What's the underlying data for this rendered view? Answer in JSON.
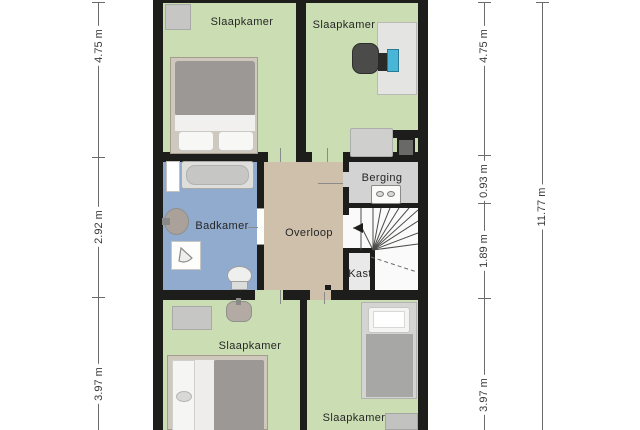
{
  "rooms": [
    {
      "id": "bedroom-top-left",
      "label": "Slaapkamer"
    },
    {
      "id": "bedroom-top-right",
      "label": "Slaapkamer"
    },
    {
      "id": "bathroom",
      "label": "Badkamer"
    },
    {
      "id": "landing",
      "label": "Overloop"
    },
    {
      "id": "storage",
      "label": "Berging"
    },
    {
      "id": "closet",
      "label": "Kast"
    },
    {
      "id": "bedroom-bottom-left",
      "label": "Slaapkamer"
    },
    {
      "id": "bedroom-bottom-right",
      "label": "Slaapkamer"
    }
  ],
  "dimensions": {
    "left": [
      "4.75 m",
      "2.92 m",
      "3.97 m"
    ],
    "right_inner": [
      "4.75 m",
      "0.93 m",
      "1.89 m",
      "3.97 m"
    ],
    "right_outer": [
      "11.77 m"
    ]
  },
  "icons": {
    "stairs_direction": "arrow-left",
    "washing_machine": "double-knob-appliance",
    "shower": "spray-fan"
  },
  "colors": {
    "wall": "#1d1d1b",
    "floor_green": "#cbdeb3",
    "floor_tan": "#cec0ab",
    "floor_blue": "#90abce",
    "floor_storage": "#d3d3d3",
    "floor_stairs": "#fafafa",
    "floor_closet": "#e9e9e9",
    "duvet_grey": "#9c9896",
    "bed_frame": "#cfc8bc",
    "monitor_accent": "#49b6d8",
    "dim_text": "#3a3a3a"
  }
}
